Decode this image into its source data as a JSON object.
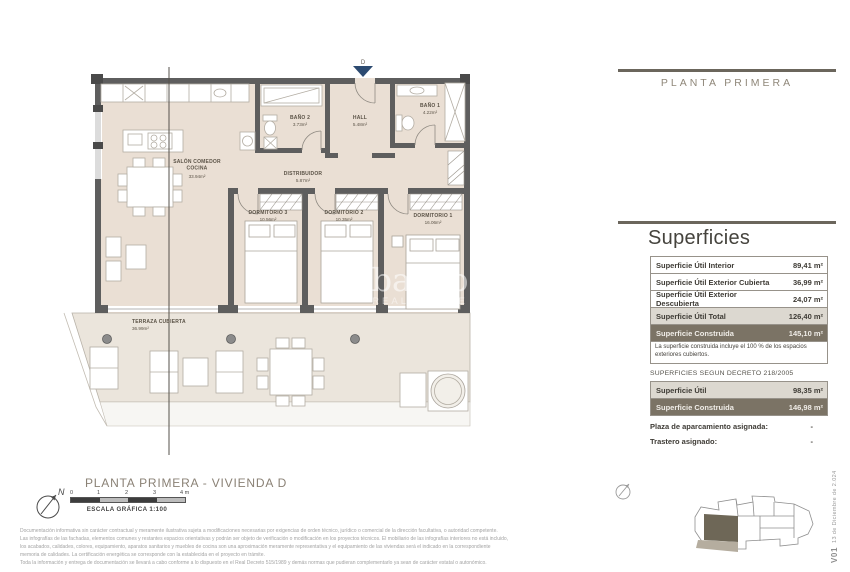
{
  "panel": {
    "header": "PLANTA PRIMERA",
    "section_title": "Superficies",
    "table1": {
      "rows": [
        {
          "label": "Superficie Útil Interior",
          "value": "89,41 m²"
        },
        {
          "label": "Superficie Útil Exterior Cubierta",
          "value": "36,99 m²"
        },
        {
          "label": "Superficie Útil Exterior Descubierta",
          "value": "24,07 m²"
        },
        {
          "label": "Superficie Útil Total",
          "value": "126,40 m²"
        },
        {
          "label": "Superficie Construida",
          "value": "145,10 m²"
        }
      ],
      "note": "La superficie construida incluye el 100 % de los espacios exteriores cubiertos."
    },
    "decree_title": "SUPERFICIES SEGUN DECRETO 218/2005",
    "table2": {
      "rows": [
        {
          "label": "Superficie Útil",
          "value": "98,35 m²"
        },
        {
          "label": "Superficie Construida",
          "value": "146,98 m²"
        }
      ]
    },
    "assignments": [
      {
        "label": "Plaza de aparcamiento asignada:",
        "value": "-"
      },
      {
        "label": "Trastero asignado:",
        "value": "-"
      }
    ]
  },
  "floorplan": {
    "entrance_marker": "D",
    "rooms": {
      "salon": {
        "name_line1": "SALÓN COMEDOR",
        "name_line2": "COCINA",
        "area": "33.94m²"
      },
      "bano2": {
        "name": "BAÑO 2",
        "area": "3.73m²"
      },
      "hall": {
        "name": "HALL",
        "area": "5.48m²"
      },
      "bano1": {
        "name": "BAÑO 1",
        "area": "4.22m²"
      },
      "distribuidor": {
        "name": "DISTRIBUIDOR",
        "area": "5.87m²"
      },
      "dormitorio3": {
        "name": "DORMITORIO 3",
        "area": "10.56m²"
      },
      "dormitorio2": {
        "name": "DORMITORIO 2",
        "area": "10.35m²"
      },
      "dormitorio1": {
        "name": "DORMITORIO 1",
        "area": "16.06m²"
      },
      "terraza": {
        "name": "TERRAZA CUBIERTA",
        "area": "36.99m²"
      }
    },
    "caption": "PLANTA PRIMERA - VIVIENDA D",
    "watermark": {
      "line1": "obacapa",
      "line2": "REAL ESTATE"
    }
  },
  "scale_bar": {
    "ticks": [
      "0",
      "1",
      "2",
      "3",
      "4 m"
    ],
    "caption": "ESCALA GRÁFICA   1:100",
    "north_label": "N"
  },
  "legal": {
    "p1_lines": [
      "Documentación informativa sin carácter contractual y meramente ilustrativa sujeta a modificaciones necesarias por exigencias de orden técnico, jurídico o comercial de la dirección facultativa, o autoridad competente.",
      "Las infografías de las fachadas, elementos comunes y restantes espacios orientativas y podrán ser objeto de verificación o modificación en los proyectos técnicos. El mobiliario de las infografías interiores no está incluido,",
      "los acabados, calidades, colores, equipamiento, aparatos sanitarios y muebles de cocina son una aproximación meramente representativa y el equipamiento de las viviendas será el indicado en la correspondiente",
      "memoria de calidades. La certificación energética se corresponde con la establecida en el proyecto en trámite."
    ],
    "p2": "Toda la información y entrega de documentación se llevará a cabo conforme a lo dispuesto en el Real Decreto 515/1989 y demás normas que pudieran complementarlo ya sean de carácter estatal o autonómico."
  },
  "version": {
    "code": "V01",
    "date": "13 de Diciembre de 2.024"
  }
}
